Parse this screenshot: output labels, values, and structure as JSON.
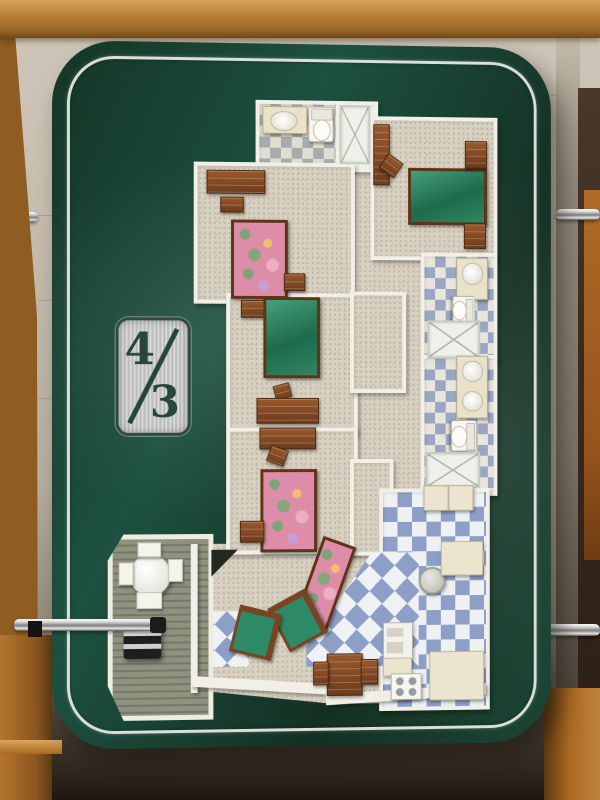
{
  "badge": {
    "bedrooms": "4",
    "separator": "/",
    "bathrooms": "3"
  },
  "palette": {
    "board_green": "#1d4b39",
    "pinstripe_silver": "#e6e8e4",
    "wall_beige": "#c8bfb2",
    "wall_white": "#f2efe7",
    "carpet": "#d8d1c2",
    "bed_green": "#2e8a66",
    "floral_pink": "#de8da8",
    "furniture_wood": "#7e4523",
    "tile_blue": "#8d9fc6",
    "tile_gray": "#a6abae",
    "deck_wood": "#83887a",
    "case_wood": "#b5772f",
    "chrome": "#d8d8d8"
  },
  "scene": {
    "furniture": [
      {
        "name": "dresser-long-bedroom2",
        "type": "wood",
        "x": 100,
        "y": 76,
        "w": 58,
        "h": 22
      },
      {
        "name": "nightstand-bedroom2",
        "type": "wood",
        "x": 114,
        "y": 103,
        "w": 22,
        "h": 14
      },
      {
        "name": "bed-floral-bedroom2",
        "type": "bed-floral",
        "x": 125,
        "y": 126,
        "w": 52,
        "h": 74
      },
      {
        "name": "chest-bedroom2",
        "type": "wood",
        "x": 179,
        "y": 180,
        "w": 20,
        "h": 16
      },
      {
        "name": "vanity-bath2",
        "type": "vanity-oval",
        "x": 157,
        "y": 11,
        "w": 44,
        "h": 26
      },
      {
        "name": "toilet-bath2",
        "type": "toilet",
        "x": 204,
        "y": 11,
        "w": 24,
        "h": 34
      },
      {
        "name": "shower-bath2",
        "type": "shower",
        "x": 236,
        "y": 9,
        "w": 28,
        "h": 56
      },
      {
        "name": "dresser-bedroom1",
        "type": "wood",
        "x": 271,
        "y": 28,
        "w": 15,
        "h": 60
      },
      {
        "name": "desk-chair-bedroom1",
        "type": "wood",
        "x": 280,
        "y": 61,
        "w": 17,
        "h": 16,
        "rot": 35
      },
      {
        "name": "bed-green-bedroom1",
        "type": "bed-green",
        "x": 307,
        "y": 72,
        "w": 76,
        "h": 52
      },
      {
        "name": "chest-bedroom1",
        "type": "wood",
        "x": 366,
        "y": 44,
        "w": 21,
        "h": 26
      },
      {
        "name": "nightstand-bedroom1",
        "type": "wood",
        "x": 365,
        "y": 128,
        "w": 21,
        "h": 24
      },
      {
        "name": "nightstand-bedroom3",
        "type": "wood",
        "x": 135,
        "y": 207,
        "w": 22,
        "h": 16
      },
      {
        "name": "bed-green-bedroom3",
        "type": "bed-green",
        "x": 158,
        "y": 204,
        "w": 52,
        "h": 76
      },
      {
        "name": "chair-bedroom3",
        "type": "wood",
        "x": 169,
        "y": 292,
        "w": 15,
        "h": 13,
        "rot": -15
      },
      {
        "name": "desk-bedroom3",
        "type": "wood",
        "x": 151,
        "y": 306,
        "w": 62,
        "h": 24
      },
      {
        "name": "desk-bedroom4",
        "type": "wood",
        "x": 154,
        "y": 336,
        "w": 56,
        "h": 20
      },
      {
        "name": "desk-chair-bedroom4",
        "type": "wood",
        "x": 163,
        "y": 356,
        "w": 17,
        "h": 15,
        "rot": 20
      },
      {
        "name": "bed-floral-bedroom4",
        "type": "bed-floral",
        "x": 155,
        "y": 378,
        "w": 52,
        "h": 78
      },
      {
        "name": "nightstand-bedroom4",
        "type": "wood",
        "x": 134,
        "y": 430,
        "w": 23,
        "h": 20
      },
      {
        "name": "vanity-master-bath",
        "type": "vanity-round",
        "x": 357,
        "y": 163,
        "w": 31,
        "h": 41
      },
      {
        "name": "toilet-master-bath",
        "type": "toilet",
        "x": 351,
        "y": 204,
        "w": 26,
        "h": 22,
        "rot": 90
      },
      {
        "name": "shower-master-bath",
        "type": "shower",
        "x": 327,
        "y": 227,
        "w": 51,
        "h": 35
      },
      {
        "name": "double-vanity-bath3",
        "type": "vanity-round2",
        "x": 357,
        "y": 263,
        "w": 31,
        "h": 62
      },
      {
        "name": "toilet-bath3",
        "type": "toilet",
        "x": 349,
        "y": 331,
        "w": 30,
        "h": 25,
        "rot": 90
      },
      {
        "name": "shower-bath3",
        "type": "shower",
        "x": 325,
        "y": 361,
        "w": 53,
        "h": 33
      },
      {
        "name": "washer-dryer",
        "type": "washer",
        "x": 323,
        "y": 395,
        "w": 50,
        "h": 24
      },
      {
        "name": "water-heater",
        "type": "heater",
        "x": 318,
        "y": 478,
        "w": 24,
        "h": 24
      },
      {
        "name": "kitchen-counter-east",
        "type": "counter",
        "x": 341,
        "y": 452,
        "w": 42,
        "h": 33
      },
      {
        "name": "refrigerator",
        "type": "fridge",
        "x": 281,
        "y": 534,
        "w": 29,
        "h": 36
      },
      {
        "name": "kitchen-counter-west",
        "type": "counter",
        "x": 281,
        "y": 570,
        "w": 28,
        "h": 17
      },
      {
        "name": "stove",
        "type": "stove",
        "x": 289,
        "y": 586,
        "w": 30,
        "h": 25
      },
      {
        "name": "kitchen-cabinets-south",
        "type": "counter",
        "x": 329,
        "y": 564,
        "w": 55,
        "h": 48
      },
      {
        "name": "sofa-floral-living",
        "type": "sofa-floral",
        "x": 203,
        "y": 449,
        "w": 30,
        "h": 86,
        "rot": 20
      },
      {
        "name": "armchair-living-1",
        "type": "armchair",
        "x": 171,
        "y": 506,
        "w": 35,
        "h": 41,
        "rot": -28
      },
      {
        "name": "armchair-living-2",
        "type": "armchair",
        "x": 128,
        "y": 519,
        "w": 35,
        "h": 39,
        "rot": 14
      },
      {
        "name": "tv-corner-unit",
        "type": "tv",
        "x": 105,
        "y": 459,
        "w": 27,
        "h": 27
      },
      {
        "name": "dining-table",
        "type": "wood",
        "x": 223,
        "y": 565,
        "w": 35,
        "h": 41
      },
      {
        "name": "dining-chair-left",
        "type": "wood",
        "x": 209,
        "y": 573,
        "w": 14,
        "h": 22
      },
      {
        "name": "dining-chair-right",
        "type": "wood",
        "x": 258,
        "y": 571,
        "w": 16,
        "h": 24
      },
      {
        "name": "patio-table",
        "type": "deck-table",
        "x": 22,
        "y": 463,
        "w": 40,
        "h": 40
      },
      {
        "name": "patio-chair-north",
        "type": "deck-chair",
        "x": 30,
        "y": 451,
        "w": 22,
        "h": 13
      },
      {
        "name": "patio-chair-east",
        "type": "deck-chair",
        "x": 61,
        "y": 468,
        "w": 13,
        "h": 21
      },
      {
        "name": "patio-chair-west",
        "type": "deck-chair",
        "x": 11,
        "y": 471,
        "w": 13,
        "h": 21
      },
      {
        "name": "patio-chair-south",
        "type": "deck-chair",
        "x": 29,
        "y": 501,
        "w": 24,
        "h": 15
      },
      {
        "name": "barbecue-grill",
        "type": "grill",
        "x": 16,
        "y": 534,
        "w": 38,
        "h": 34
      }
    ]
  }
}
